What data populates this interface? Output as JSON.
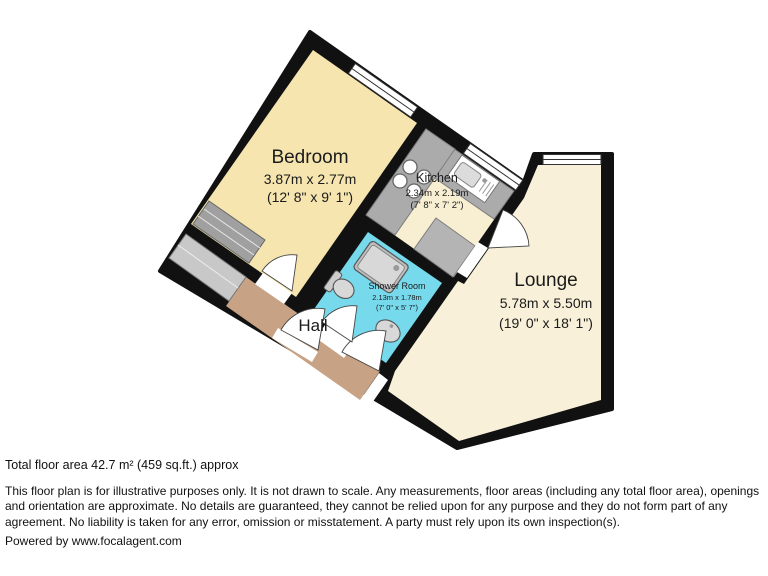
{
  "plan": {
    "rooms": [
      {
        "name": "Bedroom",
        "metric": "3.87m x 2.77m",
        "imperial": "(12' 8\" x 9' 1\")"
      },
      {
        "name": "Kitchen",
        "metric": "2.34m x 2.19m",
        "imperial": "(7' 8\" x 7' 2\")"
      },
      {
        "name": "Shower Room",
        "metric": "2.13m x 1.78m",
        "imperial": "(7' 0\" x 5' 7\")"
      },
      {
        "name": "Lounge",
        "metric": "5.78m x 5.50m",
        "imperial": "(19' 0\" x 18' 1\")"
      },
      {
        "name": "Hall",
        "metric": "",
        "imperial": ""
      }
    ],
    "colors": {
      "wall": "#111111",
      "bedroom_floor": "#F6E5AF",
      "kitchen_floor": "#F8EFD3",
      "lounge_floor": "#F8F0D8",
      "hall_floor": "#C7A284",
      "shower_floor": "#76D9EC",
      "counter_gray": "#ABABAB",
      "fixture_gray": "#D8D8D8"
    }
  },
  "footer": {
    "total_area": "Total floor area 42.7 m² (459 sq.ft.) approx",
    "disclaimer": "This floor plan is for illustrative purposes only. It is not drawn to scale. Any measurements, floor areas (including any total floor area), openings and orientation are approximate. No details are guaranteed, they cannot be relied upon for any purpose and they do not form part of any agreement. No liability is taken for any error, omission or misstatement. A party must rely upon its own inspection(s).",
    "powered_by": "Powered by www.focalagent.com"
  }
}
